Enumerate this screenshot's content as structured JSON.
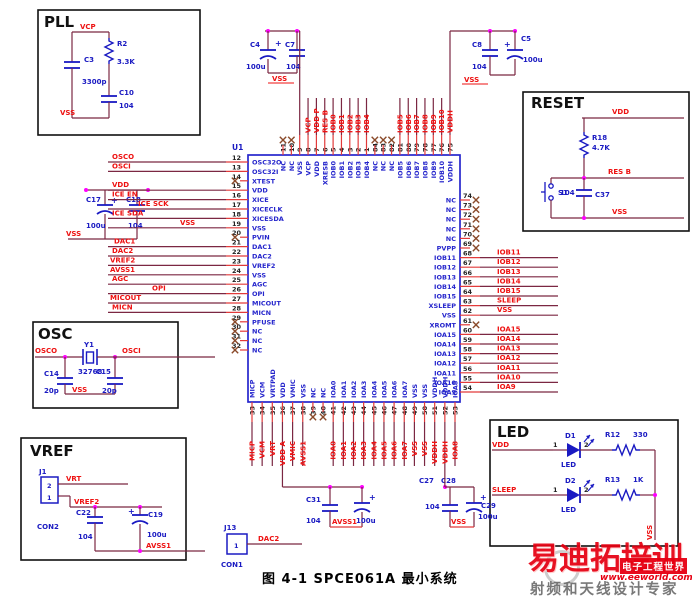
{
  "figure": {
    "caption": "图 4-1 SPCE061A 最小系统"
  },
  "chip": {
    "ref": "U1",
    "left_pins": [
      {
        "num": "12",
        "name": "OSC32O",
        "net": "OSCO"
      },
      {
        "num": "13",
        "name": "OSC32I",
        "net": "OSCI"
      },
      {
        "num": "14",
        "name": "XTEST",
        "nc": true
      },
      {
        "num": "15",
        "name": "VDD",
        "net": "VDD"
      },
      {
        "num": "16",
        "name": "XICE",
        "net": "ICE EN"
      },
      {
        "num": "17",
        "name": "XICECLK",
        "net": "ICE SCK"
      },
      {
        "num": "18",
        "name": "XICESDA",
        "net": "ICE SDA"
      },
      {
        "num": "19",
        "name": "VSS",
        "net": "VSS"
      },
      {
        "num": "20",
        "name": "PVIN",
        "nc": true
      },
      {
        "num": "21",
        "name": "DAC1",
        "net": "DAC1"
      },
      {
        "num": "22",
        "name": "DAC2",
        "net": "DAC2"
      },
      {
        "num": "23",
        "name": "VREF2",
        "net": "VREF2"
      },
      {
        "num": "24",
        "name": "VSS",
        "net": "AVSS1"
      },
      {
        "num": "25",
        "name": "AGC",
        "net": "AGC"
      },
      {
        "num": "26",
        "name": "OPI",
        "net": "OPI"
      },
      {
        "num": "27",
        "name": "MICOUT",
        "net": "MICOUT"
      },
      {
        "num": "28",
        "name": "MICN",
        "net": "MICN"
      },
      {
        "num": "29",
        "name": "PFUSE",
        "nc": true
      },
      {
        "num": "30",
        "name": "NC",
        "nc": true
      },
      {
        "num": "31",
        "name": "NC",
        "nc": true
      },
      {
        "num": "32",
        "name": "NC",
        "nc": true
      }
    ],
    "top_pins": [
      {
        "num": "11",
        "name": "NC",
        "nc": true
      },
      {
        "num": "10",
        "name": "NC",
        "nc": true
      },
      {
        "num": "9",
        "name": "VSS",
        "rail": true
      },
      {
        "num": "8",
        "name": "VCP",
        "net": "VCP"
      },
      {
        "num": "7",
        "name": "VDD",
        "net": "VDD P"
      },
      {
        "num": "6",
        "name": "XRESB",
        "net": "RES B"
      },
      {
        "num": "5",
        "name": "IOB0",
        "net": "IOB0"
      },
      {
        "num": "4",
        "name": "IOB1",
        "net": "IOB1"
      },
      {
        "num": "3",
        "name": "IOB2",
        "net": "IOB2"
      },
      {
        "num": "2",
        "name": "IOB3",
        "net": "IOB3"
      },
      {
        "num": "1",
        "name": "IOB4",
        "net": "IOB4"
      },
      {
        "num": "84",
        "name": "NC",
        "nc": true
      },
      {
        "num": "83",
        "name": "NC",
        "nc": true
      },
      {
        "num": "82",
        "name": "NC",
        "nc": true
      },
      {
        "num": "81",
        "name": "IOB5",
        "net": "IOB5"
      },
      {
        "num": "80",
        "name": "IOB6",
        "net": "IOB6"
      },
      {
        "num": "79",
        "name": "IOB7",
        "net": "IOB7"
      },
      {
        "num": "78",
        "name": "IOB8",
        "net": "IOB8"
      },
      {
        "num": "77",
        "name": "IOB9",
        "net": "IOB9"
      },
      {
        "num": "76",
        "name": "IOB10",
        "net": "IOB10"
      },
      {
        "num": "75",
        "name": "VDDH",
        "net": "VDDH",
        "rail": true
      }
    ],
    "right_pins": [
      {
        "num": "74",
        "name": "NC",
        "nc": true
      },
      {
        "num": "73",
        "name": "NC",
        "nc": true
      },
      {
        "num": "72",
        "name": "NC",
        "nc": true
      },
      {
        "num": "71",
        "name": "NC",
        "nc": true
      },
      {
        "num": "70",
        "name": "NC",
        "nc": true
      },
      {
        "num": "69",
        "name": "PVPP",
        "nc": true
      },
      {
        "num": "68",
        "name": "IOB11",
        "net": "IOB11"
      },
      {
        "num": "67",
        "name": "IOB12",
        "net": "IOB12"
      },
      {
        "num": "66",
        "name": "IOB13",
        "net": "IOB13"
      },
      {
        "num": "65",
        "name": "IOB14",
        "net": "IOB14"
      },
      {
        "num": "64",
        "name": "IOB15",
        "net": "IOB15"
      },
      {
        "num": "63",
        "name": "XSLEEP",
        "net": "SLEEP"
      },
      {
        "num": "62",
        "name": "VSS",
        "net": "VSS"
      },
      {
        "num": "61",
        "name": "XROMT",
        "nc": true
      },
      {
        "num": "60",
        "name": "IOA15",
        "net": "IOA15"
      },
      {
        "num": "59",
        "name": "IOA14",
        "net": "IOA14"
      },
      {
        "num": "58",
        "name": "IOA13",
        "net": "IOA13"
      },
      {
        "num": "57",
        "name": "IOA12",
        "net": "IOA12"
      },
      {
        "num": "56",
        "name": "IOA11",
        "net": "IOA11"
      },
      {
        "num": "55",
        "name": "IOA10",
        "net": "IOA10"
      },
      {
        "num": "54",
        "name": "IOA9",
        "net": "IOA9"
      }
    ],
    "bottom_pins": [
      {
        "num": "33",
        "name": "MICP",
        "net": "MICP"
      },
      {
        "num": "34",
        "name": "VCM",
        "net": "VCM"
      },
      {
        "num": "35",
        "name": "VRTPAD",
        "net": "VRT"
      },
      {
        "num": "36",
        "name": "VDD",
        "net": "VDD A",
        "ext": true
      },
      {
        "num": "37",
        "name": "VMIC",
        "net": "VMIC"
      },
      {
        "num": "38",
        "name": "VSS",
        "net": "AVSS1"
      },
      {
        "num": "39",
        "name": "NC",
        "nc": true
      },
      {
        "num": "40",
        "name": "NC",
        "nc": true
      },
      {
        "num": "41",
        "name": "IOA0",
        "net": "IOA0"
      },
      {
        "num": "42",
        "name": "IOA1",
        "net": "IOA1"
      },
      {
        "num": "43",
        "name": "IOA2",
        "net": "IOA2"
      },
      {
        "num": "44",
        "name": "IOA3",
        "net": "IOA3"
      },
      {
        "num": "45",
        "name": "IOA4",
        "net": "IOA4"
      },
      {
        "num": "46",
        "name": "IOA5",
        "net": "IOA5"
      },
      {
        "num": "47",
        "name": "IOA6",
        "net": "IOA6"
      },
      {
        "num": "48",
        "name": "IOA7",
        "net": "IOA7"
      },
      {
        "num": "49",
        "name": "VSS",
        "net": "VSS"
      },
      {
        "num": "50",
        "name": "VSS",
        "net": "VSS"
      },
      {
        "num": "51",
        "name": "VDDH",
        "net": "VDDH"
      },
      {
        "num": "52",
        "name": "VDDH",
        "net": "VDDH",
        "ext": true
      },
      {
        "num": "53",
        "name": "IOA8",
        "net": "IOA8"
      }
    ]
  },
  "pll": {
    "title": "PLL",
    "net_top": "VCP",
    "net_bottom": "VSS",
    "c3": "C3",
    "c3_value": "3300p",
    "r2": "R2",
    "r2_value": "3.3K",
    "c10": "C10",
    "c10_value": "104"
  },
  "decoupling_left": {
    "c4": "C4",
    "c4_value": "100u",
    "plus": "+",
    "c7": "C7",
    "c7_value": "104",
    "net": "VSS"
  },
  "decoupling_right": {
    "c8": "C8",
    "c8_value": "104",
    "c5": "C5",
    "c5_value": "100u",
    "plus": "+",
    "net": "VSS"
  },
  "vdd_caps": {
    "c17": "C17",
    "c17_value": "100u",
    "plus": "+",
    "c18": "C18",
    "c18_value": "104",
    "net_vss": "VSS"
  },
  "reset": {
    "title": "RESET",
    "net_vdd": "VDD",
    "net_resb": "RES B",
    "net_vss": "VSS",
    "r18": "R18",
    "r18_value": "4.7K",
    "s1": "S1",
    "c37": "C37",
    "c37_value": "104"
  },
  "osc": {
    "title": "OSC",
    "net_left": "OSCO",
    "net_right": "OSCI",
    "y1": "Y1",
    "y1_value": "32768",
    "c14": "C14",
    "c14_value": "20p",
    "c15": "C15",
    "c15_value": "20p",
    "net_vss": "VSS"
  },
  "vref": {
    "title": "VREF",
    "j1": "J1",
    "j1_type": "CON2",
    "pin2": "2",
    "pin1": "1",
    "net_vrt": "VRT",
    "net_vref2": "VREF2",
    "net_avss": "AVSS1",
    "c22": "C22",
    "c22_value": "104",
    "plus": "+",
    "c19": "C19",
    "c19_value": "100u"
  },
  "led": {
    "title": "LED",
    "net_vss": "VSS",
    "rows": [
      {
        "net": "VDD",
        "pin1": "1",
        "diode": "D1",
        "diode_label": "LED",
        "pin2": "2",
        "res": "R12",
        "res_value": "330"
      },
      {
        "net": "SLEEP",
        "pin1": "1",
        "diode": "D2",
        "diode_label": "LED",
        "pin2": "2",
        "res": "R13",
        "res_value": "1K"
      }
    ]
  },
  "avss_filter": {
    "c31": "C31",
    "c31_value": "104",
    "plus": "+",
    "bulk_value": "100u",
    "net": "AVSS1"
  },
  "vss_filter": {
    "c27": "C27",
    "c28": "C28",
    "c28_value": "104",
    "plus": "+",
    "c29": "C29",
    "c29_value": "100u",
    "net": "VSS"
  },
  "j13": {
    "ref": "J13",
    "type": "CON1",
    "pin": "1",
    "net": "DAC2"
  },
  "watermark": {
    "brand": "易迪拓培训",
    "badge": "电子工程世界",
    "url": "www.eeworld.com.cn",
    "tagline": "射频和天线设计专家"
  }
}
